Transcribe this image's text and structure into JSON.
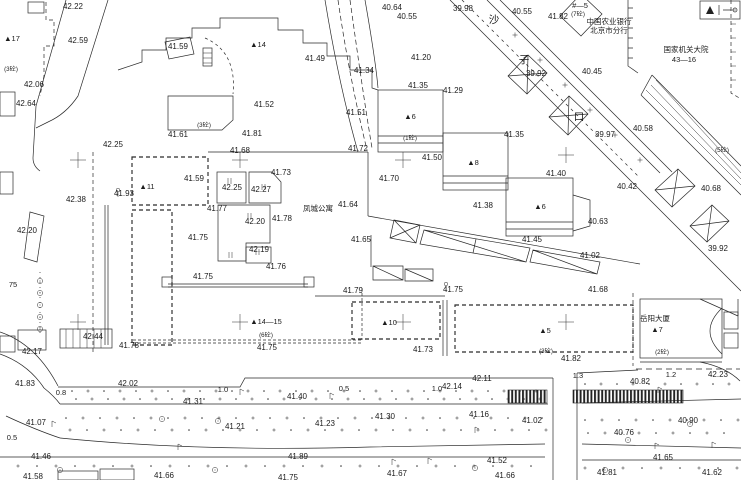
{
  "map": {
    "background": "#ffffff",
    "line_color": "#2a2a2a",
    "label_color": "#1c1c1c",
    "spot_elevations": [
      {
        "t": "42.22",
        "x": 73,
        "y": 6
      },
      {
        "t": "42.59",
        "x": 78,
        "y": 40
      },
      {
        "t": "41.59",
        "x": 178,
        "y": 46
      },
      {
        "t": "42.06",
        "x": 34,
        "y": 84
      },
      {
        "t": "42.64",
        "x": 26,
        "y": 103
      },
      {
        "t": "42.25",
        "x": 113,
        "y": 144
      },
      {
        "t": "41.61",
        "x": 178,
        "y": 134
      },
      {
        "t": "41.68",
        "x": 240,
        "y": 150
      },
      {
        "t": "41.81",
        "x": 252,
        "y": 133
      },
      {
        "t": "41.93",
        "x": 124,
        "y": 193
      },
      {
        "t": "42.38",
        "x": 76,
        "y": 199
      },
      {
        "t": "42.20",
        "x": 27,
        "y": 230
      },
      {
        "t": "41.49",
        "x": 315,
        "y": 58
      },
      {
        "t": "41.52",
        "x": 264,
        "y": 104
      },
      {
        "t": "41.34",
        "x": 364,
        "y": 70
      },
      {
        "t": "41.51",
        "x": 356,
        "y": 112
      },
      {
        "t": "41.72",
        "x": 358,
        "y": 148
      },
      {
        "t": "40.64",
        "x": 392,
        "y": 7
      },
      {
        "t": "40.55",
        "x": 407,
        "y": 16
      },
      {
        "t": "39.98",
        "x": 463,
        "y": 8
      },
      {
        "t": "40.55",
        "x": 522,
        "y": 11
      },
      {
        "t": "41.82",
        "x": 558,
        "y": 16
      },
      {
        "t": "41.20",
        "x": 421,
        "y": 57
      },
      {
        "t": "41.35",
        "x": 418,
        "y": 85
      },
      {
        "t": "41.29",
        "x": 453,
        "y": 90
      },
      {
        "t": "39.92",
        "x": 536,
        "y": 73
      },
      {
        "t": "40.45",
        "x": 592,
        "y": 71
      },
      {
        "t": "40.58",
        "x": 643,
        "y": 128
      },
      {
        "t": "39.97",
        "x": 605,
        "y": 134
      },
      {
        "t": "41.35",
        "x": 514,
        "y": 134
      },
      {
        "t": "40.42",
        "x": 627,
        "y": 186
      },
      {
        "t": "40.68",
        "x": 711,
        "y": 188
      },
      {
        "t": "39.92",
        "x": 718,
        "y": 248
      },
      {
        "t": "40.63",
        "x": 598,
        "y": 221
      },
      {
        "t": "41.02",
        "x": 590,
        "y": 255
      },
      {
        "t": "41.68",
        "x": 598,
        "y": 289
      },
      {
        "t": "41.50",
        "x": 432,
        "y": 157
      },
      {
        "t": "41.40",
        "x": 556,
        "y": 173
      },
      {
        "t": "41.38",
        "x": 483,
        "y": 205
      },
      {
        "t": "41.45",
        "x": 532,
        "y": 239
      },
      {
        "t": "41.59",
        "x": 194,
        "y": 178
      },
      {
        "t": "41.73",
        "x": 281,
        "y": 172
      },
      {
        "t": "42.25",
        "x": 232,
        "y": 187
      },
      {
        "t": "42.27",
        "x": 261,
        "y": 189
      },
      {
        "t": "41.77",
        "x": 217,
        "y": 208
      },
      {
        "t": "42.20",
        "x": 255,
        "y": 221
      },
      {
        "t": "41.78",
        "x": 282,
        "y": 218
      },
      {
        "t": "41.75",
        "x": 198,
        "y": 237
      },
      {
        "t": "42.19",
        "x": 259,
        "y": 249
      },
      {
        "t": "41.76",
        "x": 276,
        "y": 266
      },
      {
        "t": "41.75",
        "x": 203,
        "y": 276
      },
      {
        "t": "41.70",
        "x": 389,
        "y": 178
      },
      {
        "t": "41.64",
        "x": 348,
        "y": 204
      },
      {
        "t": "41.65",
        "x": 361,
        "y": 239
      },
      {
        "t": "41.79",
        "x": 353,
        "y": 290
      },
      {
        "t": "41.75",
        "x": 453,
        "y": 289
      },
      {
        "t": "41.73",
        "x": 423,
        "y": 349
      },
      {
        "t": "41.75",
        "x": 267,
        "y": 347
      },
      {
        "t": "41.78",
        "x": 129,
        "y": 345
      },
      {
        "t": "41.82",
        "x": 571,
        "y": 358
      },
      {
        "t": "42.11",
        "x": 482,
        "y": 378
      },
      {
        "t": "42.14",
        "x": 452,
        "y": 386
      },
      {
        "t": "42.02",
        "x": 128,
        "y": 383
      },
      {
        "t": "41.40",
        "x": 297,
        "y": 396
      },
      {
        "t": "41.31",
        "x": 193,
        "y": 401
      },
      {
        "t": "41.83",
        "x": 25,
        "y": 383
      },
      {
        "t": "42.44",
        "x": 93,
        "y": 336
      },
      {
        "t": "42.17",
        "x": 32,
        "y": 351
      },
      {
        "t": "42.23",
        "x": 718,
        "y": 374
      },
      {
        "t": "40.82",
        "x": 640,
        "y": 381
      },
      {
        "t": "41.07",
        "x": 36,
        "y": 422
      },
      {
        "t": "41.21",
        "x": 235,
        "y": 426
      },
      {
        "t": "41.23",
        "x": 325,
        "y": 423
      },
      {
        "t": "41.30",
        "x": 385,
        "y": 416
      },
      {
        "t": "41.16",
        "x": 479,
        "y": 414
      },
      {
        "t": "41.02",
        "x": 532,
        "y": 420
      },
      {
        "t": "40.76",
        "x": 624,
        "y": 432
      },
      {
        "t": "40.90",
        "x": 688,
        "y": 420
      },
      {
        "t": "41.46",
        "x": 41,
        "y": 456
      },
      {
        "t": "41.89",
        "x": 298,
        "y": 456
      },
      {
        "t": "41.52",
        "x": 497,
        "y": 460
      },
      {
        "t": "41.65",
        "x": 663,
        "y": 457
      },
      {
        "t": "41.58",
        "x": 33,
        "y": 476
      },
      {
        "t": "41.66",
        "x": 164,
        "y": 475
      },
      {
        "t": "41.75",
        "x": 288,
        "y": 477
      },
      {
        "t": "41.67",
        "x": 397,
        "y": 473
      },
      {
        "t": "41.66",
        "x": 505,
        "y": 475
      },
      {
        "t": "41.81",
        "x": 607,
        "y": 472
      },
      {
        "t": "41.62",
        "x": 712,
        "y": 472
      }
    ],
    "building_numbers": [
      {
        "t": "▲17",
        "x": 12,
        "y": 38
      },
      {
        "t": "▲14",
        "x": 258,
        "y": 44
      },
      {
        "t": "▲11",
        "x": 147,
        "y": 186
      },
      {
        "t": "▲6",
        "x": 410,
        "y": 116
      },
      {
        "t": "▲8",
        "x": 473,
        "y": 162
      },
      {
        "t": "▲6",
        "x": 540,
        "y": 206
      },
      {
        "t": "▲10",
        "x": 389,
        "y": 322
      },
      {
        "t": "▲14—15",
        "x": 266,
        "y": 321
      },
      {
        "t": "▲5",
        "x": 545,
        "y": 330
      },
      {
        "t": "▲7",
        "x": 657,
        "y": 329
      },
      {
        "t": "#—5",
        "x": 580,
        "y": 5
      },
      {
        "t": "43—16",
        "x": 684,
        "y": 59
      }
    ],
    "structure_notes": [
      {
        "t": "(3砼)",
        "x": 11,
        "y": 68
      },
      {
        "t": "(3砼)",
        "x": 204,
        "y": 124
      },
      {
        "t": "(1砼)",
        "x": 410,
        "y": 137
      },
      {
        "t": "(7砼)",
        "x": 578,
        "y": 13
      },
      {
        "t": "(5砼)",
        "x": 722,
        "y": 149
      },
      {
        "t": "(6砼)",
        "x": 266,
        "y": 334
      },
      {
        "t": "(3砼)",
        "x": 546,
        "y": 350
      },
      {
        "t": "(2砼)",
        "x": 662,
        "y": 351
      }
    ],
    "place_names": [
      {
        "t": "中国农业银行",
        "x": 609,
        "y": 21
      },
      {
        "t": "北京市分行",
        "x": 609,
        "y": 30
      },
      {
        "t": "国家机关大院",
        "x": 686,
        "y": 49
      },
      {
        "t": "凤城公寓",
        "x": 318,
        "y": 208
      },
      {
        "t": "岳阳大厦",
        "x": 655,
        "y": 318
      }
    ],
    "street_name_chars": [
      {
        "t": "沙",
        "x": 494,
        "y": 20
      },
      {
        "t": "子",
        "x": 524,
        "y": 60
      },
      {
        "t": "口",
        "x": 579,
        "y": 117
      }
    ],
    "dimension_marks": [
      {
        "t": "0.8",
        "x": 61,
        "y": 392
      },
      {
        "t": "1.0",
        "x": 223,
        "y": 389
      },
      {
        "t": "0.5",
        "x": 344,
        "y": 388
      },
      {
        "t": "1.0",
        "x": 437,
        "y": 388
      },
      {
        "t": "1.3",
        "x": 578,
        "y": 375
      },
      {
        "t": "1.2",
        "x": 671,
        "y": 374
      },
      {
        "t": "0.5",
        "x": 12,
        "y": 437
      },
      {
        "t": "75",
        "x": 13,
        "y": 284
      }
    ],
    "grid_crosses": [
      {
        "x": 78,
        "y": 160
      },
      {
        "x": 240,
        "y": 160
      },
      {
        "x": 403,
        "y": 160
      },
      {
        "x": 566,
        "y": 155
      },
      {
        "x": 78,
        "y": 322
      },
      {
        "x": 240,
        "y": 322
      },
      {
        "x": 403,
        "y": 322
      },
      {
        "x": 566,
        "y": 322
      }
    ]
  }
}
